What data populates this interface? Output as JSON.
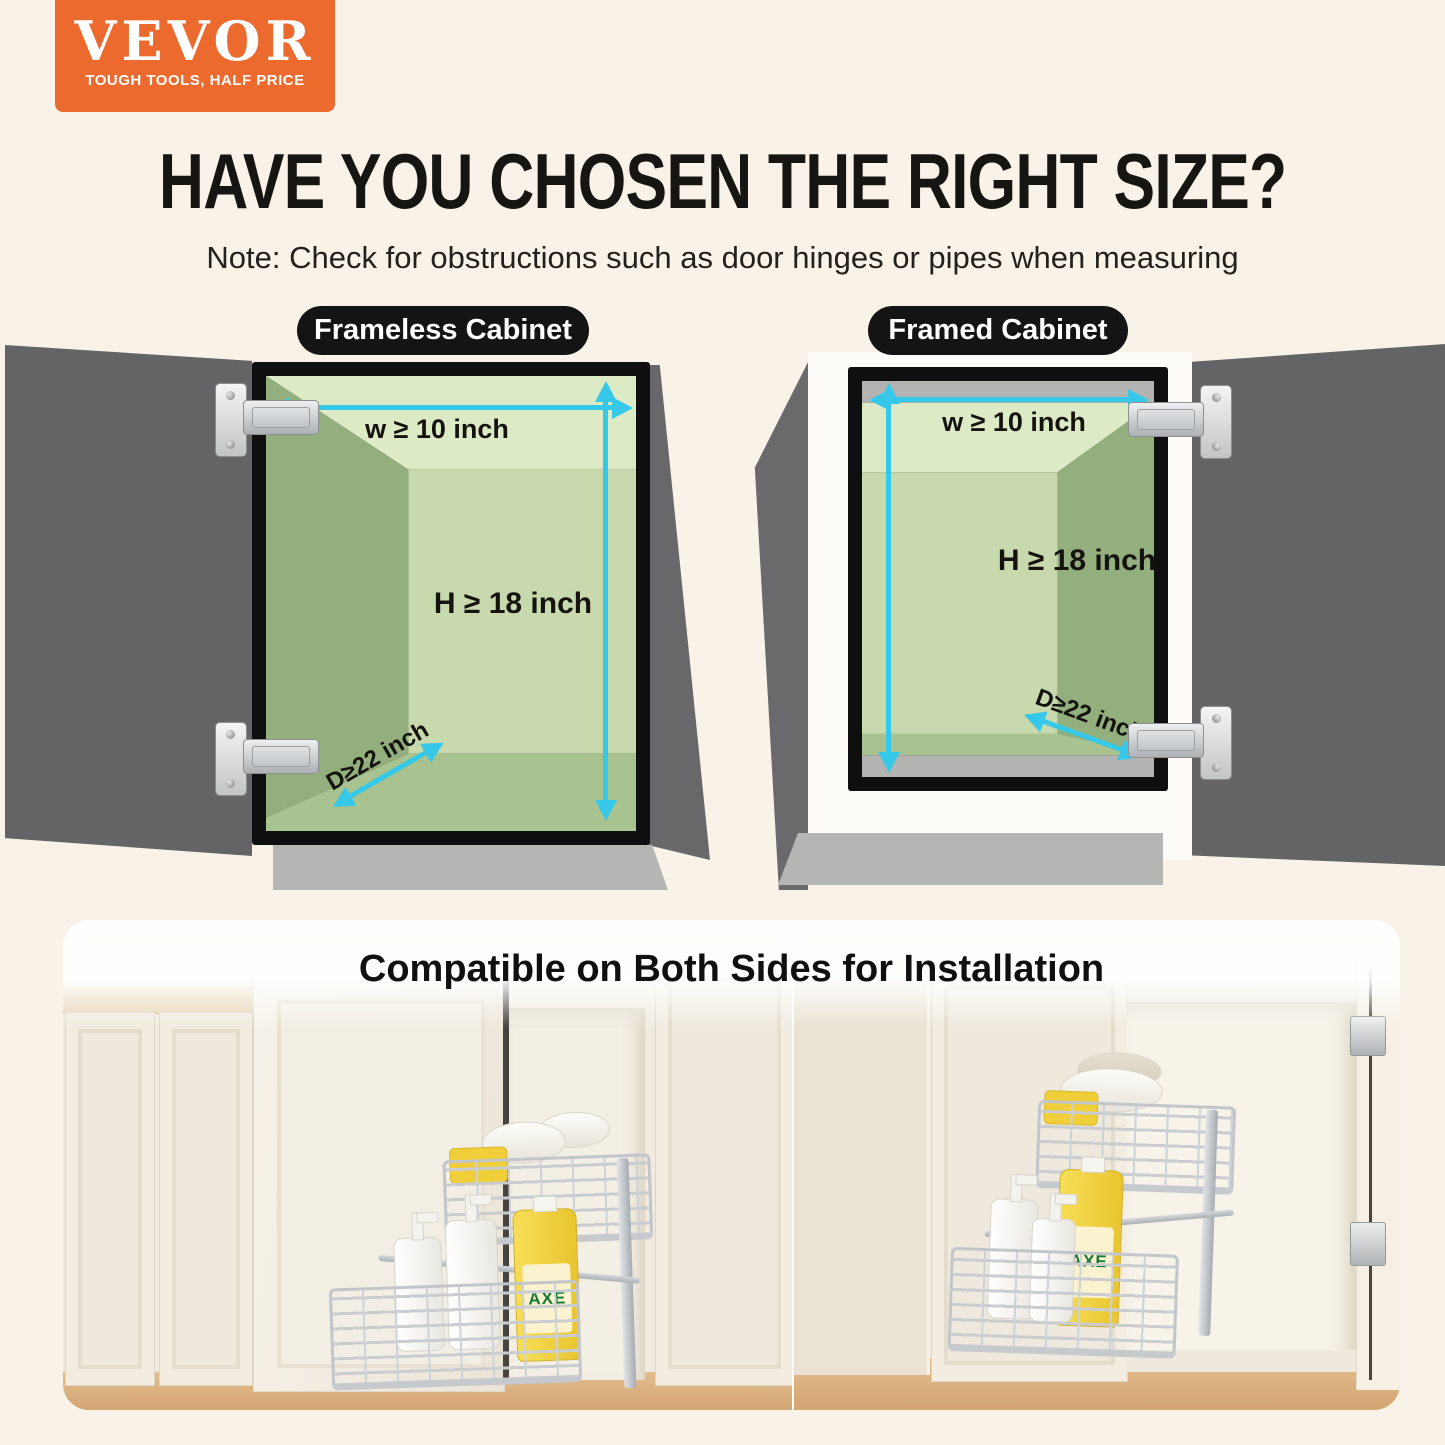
{
  "colors": {
    "bg": "#f8f2e8",
    "orange": "#ed6a2e",
    "ink": "#171512",
    "cyan": "#35c8e8",
    "frame-black": "#0f0f0f",
    "door-gray": "#646467",
    "plinth-gray": "#b5b6b4",
    "ceiling-green": "#dcebc6",
    "wall-dark-green": "#93af7d",
    "wall-back-green": "#c8daad",
    "floor-green": "#a9c390",
    "pill-black": "#141414",
    "wood-floor": "#dcb284",
    "axe-yellow": "#f2d440"
  },
  "logo": {
    "brand": "VEVOR",
    "tagline": "TOUGH TOOLS, HALF PRICE"
  },
  "header": {
    "title": "HAVE YOU CHOSEN THE RIGHT SIZE?",
    "note": "Note: Check for obstructions such as door hinges or pipes when measuring"
  },
  "diagrams": {
    "frameless": {
      "label": "Frameless Cabinet",
      "width": "w ≥ 10 inch",
      "height": "H ≥ 18 inch",
      "depth": "D≥22 inch"
    },
    "framed": {
      "label": "Framed Cabinet",
      "width": "w ≥ 10 inch",
      "height": "H ≥ 18 inch",
      "depth": "D≥22 inch"
    }
  },
  "photos": {
    "caption": "Compatible on Both Sides for Installation",
    "bottle_brand": "AXE"
  }
}
